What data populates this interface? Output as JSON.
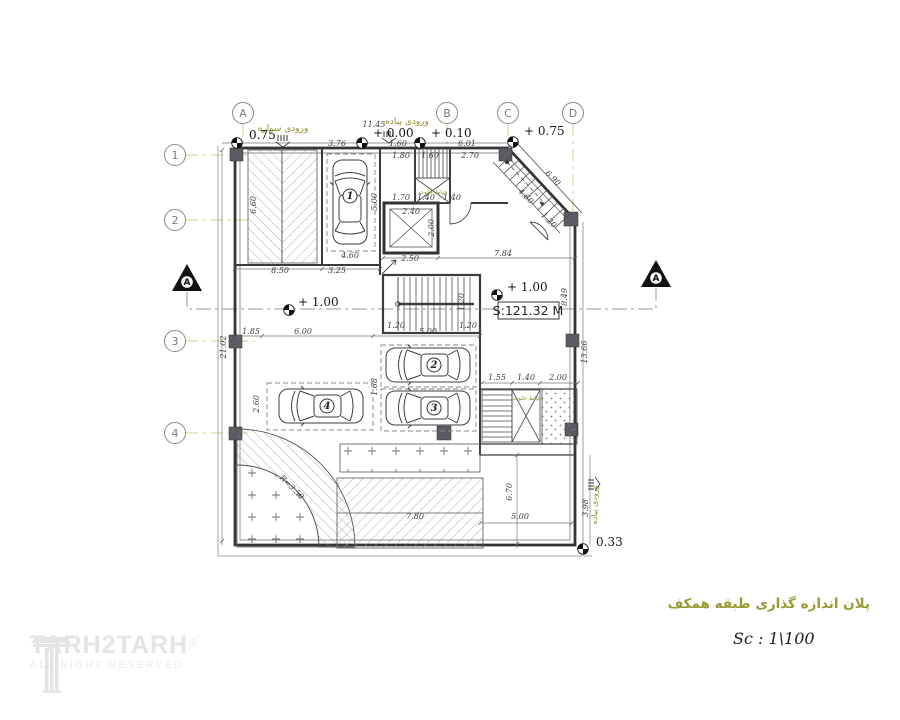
{
  "titles": {
    "plan_title_fa": "پلان اندازه گذاری طبقه همکف",
    "scale_label": "Sc  :  1\\100"
  },
  "watermark": {
    "brand": "TARH2TARH",
    "registered": "®",
    "tagline": "ALL RIGHT RESERVED"
  },
  "colors": {
    "line": "#3c3c3c",
    "grid_dashdot": "#d6cc8f",
    "annotation_olive": "#8f8f2e",
    "hatch": "#9c9c9c"
  },
  "grid": {
    "columns": [
      "A",
      "B",
      "C",
      "D"
    ],
    "rows": [
      "1",
      "2",
      "3",
      "4"
    ]
  },
  "area_label": "S:121.32 M",
  "cars": [
    "1",
    "2",
    "3",
    "4"
  ],
  "annotations": [
    {
      "t": "A",
      "x": 243,
      "y": 117,
      "c": "grid"
    },
    {
      "t": "B",
      "x": 447,
      "y": 117,
      "c": "grid"
    },
    {
      "t": "C",
      "x": 508,
      "y": 117,
      "c": "grid"
    },
    {
      "t": "D",
      "x": 573,
      "y": 117,
      "c": "grid"
    },
    {
      "t": "1",
      "x": 175,
      "y": 159,
      "c": "grid"
    },
    {
      "t": "2",
      "x": 175,
      "y": 224,
      "c": "grid"
    },
    {
      "t": "3",
      "x": 175,
      "y": 345,
      "c": "grid"
    },
    {
      "t": "4",
      "x": 175,
      "y": 437,
      "c": "grid"
    },
    {
      "t": "0.75",
      "x": 249,
      "y": 139,
      "c": "level"
    },
    {
      "t": "+ 0.00",
      "x": 373,
      "y": 137,
      "c": "level"
    },
    {
      "t": "+ 0.10",
      "x": 431,
      "y": 137,
      "c": "level"
    },
    {
      "t": "+ 0.75",
      "x": 524,
      "y": 135,
      "c": "level"
    },
    {
      "t": "+ 1.00",
      "x": 298,
      "y": 306,
      "c": "level"
    },
    {
      "t": "+ 1.00",
      "x": 507,
      "y": 291,
      "c": "level"
    },
    {
      "t": "0.33",
      "x": 596,
      "y": 546,
      "c": "level"
    },
    {
      "t": "ورودی سواره",
      "x": 283,
      "y": 131,
      "c": "fa"
    },
    {
      "t": "ورودی پیاده",
      "x": 407,
      "y": 124,
      "c": "fa"
    },
    {
      "t": "حیاط خلوت",
      "x": 433,
      "y": 194,
      "c": "fa",
      "s": 6
    },
    {
      "t": "حیاط خلوت",
      "x": 527,
      "y": 400,
      "c": "fa",
      "s": 6
    },
    {
      "t": "ورودی پیاده",
      "x": 597,
      "y": 505,
      "c": "fa",
      "s": 8,
      "r": -90
    },
    {
      "t": "S:121.32 M",
      "x": 528,
      "y": 315,
      "c": "area"
    },
    {
      "t": "1",
      "x": 350,
      "y": 199,
      "c": "carnum"
    },
    {
      "t": "2",
      "x": 434,
      "y": 368,
      "c": "carnum"
    },
    {
      "t": "3",
      "x": 434,
      "y": 411,
      "c": "carnum"
    },
    {
      "t": "4",
      "x": 327,
      "y": 409,
      "c": "carnum"
    },
    {
      "t": "A",
      "x": 187,
      "y": 285,
      "c": "sec"
    },
    {
      "t": "A",
      "x": 656,
      "y": 281,
      "c": "sec"
    },
    {
      "t": "11.45",
      "x": 374,
      "y": 127
    },
    {
      "t": "3.76",
      "x": 337,
      "y": 146
    },
    {
      "t": "1.60",
      "x": 398,
      "y": 146
    },
    {
      "t": "6.01",
      "x": 467,
      "y": 146
    },
    {
      "t": "1.80",
      "x": 401,
      "y": 158
    },
    {
      "t": "1.60",
      "x": 430,
      "y": 158
    },
    {
      "t": "2.70",
      "x": 470,
      "y": 158
    },
    {
      "t": "1.70",
      "x": 401,
      "y": 200
    },
    {
      "t": "1.40",
      "x": 426,
      "y": 200
    },
    {
      "t": "1.40",
      "x": 452,
      "y": 200
    },
    {
      "t": "2.40",
      "x": 411,
      "y": 214
    },
    {
      "t": "2.00",
      "x": 434,
      "y": 228,
      "r": -90
    },
    {
      "t": "2.50",
      "x": 410,
      "y": 261
    },
    {
      "t": "6.60",
      "x": 256,
      "y": 205,
      "r": -90
    },
    {
      "t": "5.00",
      "x": 377,
      "y": 202,
      "r": -90
    },
    {
      "t": "8.50",
      "x": 280,
      "y": 273
    },
    {
      "t": "3.25",
      "x": 337,
      "y": 273
    },
    {
      "t": "4.60",
      "x": 350,
      "y": 258
    },
    {
      "t": "21.02",
      "x": 226,
      "y": 347,
      "r": -90
    },
    {
      "t": "1.85",
      "x": 251,
      "y": 334
    },
    {
      "t": "6.00",
      "x": 303,
      "y": 334
    },
    {
      "t": "5.00",
      "x": 428,
      "y": 334
    },
    {
      "t": "2.60",
      "x": 259,
      "y": 404,
      "r": -90
    },
    {
      "t": "1.68",
      "x": 377,
      "y": 387,
      "r": -90
    },
    {
      "t": "1.20",
      "x": 396,
      "y": 328
    },
    {
      "t": "1.20",
      "x": 468,
      "y": 328
    },
    {
      "t": "1.20",
      "x": 464,
      "y": 302,
      "r": -90
    },
    {
      "t": "7.84",
      "x": 503,
      "y": 256
    },
    {
      "t": "8.49",
      "x": 567,
      "y": 297,
      "r": -90
    },
    {
      "t": "13.66",
      "x": 587,
      "y": 352,
      "r": -90
    },
    {
      "t": "6.90",
      "x": 551,
      "y": 180,
      "r": 45
    },
    {
      "t": "4.60",
      "x": 524,
      "y": 198,
      "r": 45
    },
    {
      "t": "1.20",
      "x": 547,
      "y": 222,
      "r": 45
    },
    {
      "t": "1.55",
      "x": 497,
      "y": 380
    },
    {
      "t": "1.40",
      "x": 526,
      "y": 380
    },
    {
      "t": "2.00",
      "x": 558,
      "y": 380
    },
    {
      "t": "5.00",
      "x": 520,
      "y": 519
    },
    {
      "t": "6.70",
      "x": 512,
      "y": 492,
      "r": -90
    },
    {
      "t": "3.98",
      "x": 588,
      "y": 508,
      "r": -90
    },
    {
      "t": "R=3.50",
      "x": 290,
      "y": 489,
      "r": 45
    },
    {
      "t": "7.80",
      "x": 415,
      "y": 519
    }
  ]
}
